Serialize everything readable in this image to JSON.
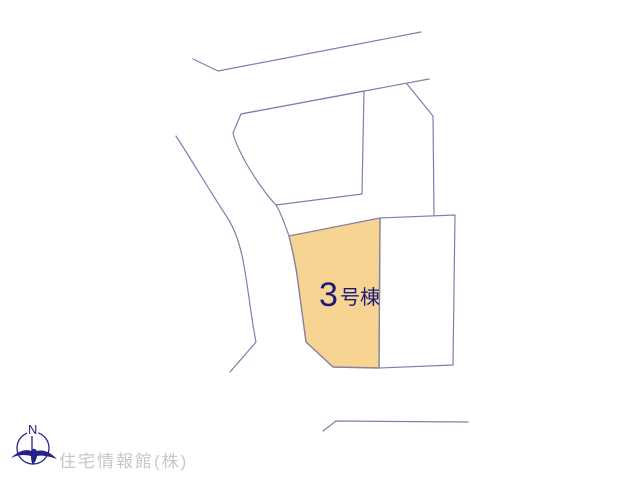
{
  "map": {
    "highlighted_parcel": {
      "label_full": "3号棟",
      "label_number": "3",
      "label_suffix": "号棟",
      "fill_color": "#f7d492",
      "label_color": "#1c1c78"
    },
    "line_color": "#7d80ac"
  },
  "compass": {
    "north_label": "N",
    "color": "#232387"
  },
  "footer": {
    "company": "住宅情報館(株)",
    "color": "#c8c8c8"
  }
}
